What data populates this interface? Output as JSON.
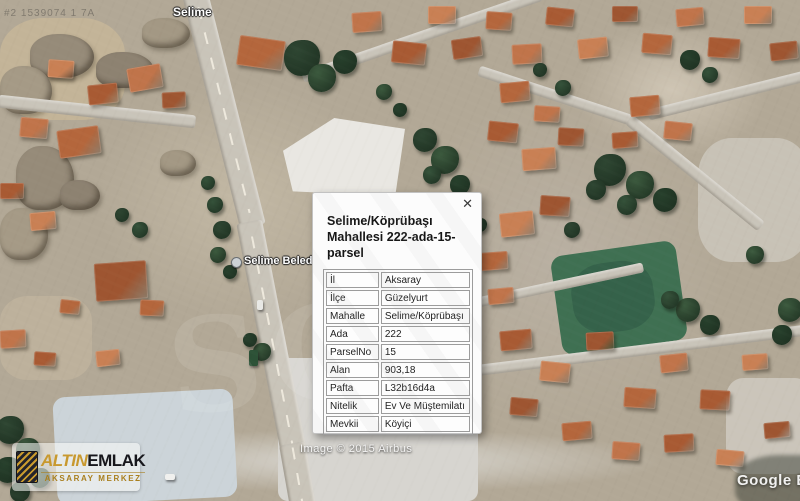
{
  "popup": {
    "title": "Selime/Köprübaşı Mahallesi 222-ada-15-parsel",
    "rows": [
      {
        "label": "İl",
        "value": "Aksaray"
      },
      {
        "label": "İlçe",
        "value": "Güzelyurt"
      },
      {
        "label": "Mahalle",
        "value": "Selime/Köprübaşı"
      },
      {
        "label": "Ada",
        "value": "222"
      },
      {
        "label": "ParselNo",
        "value": "15"
      },
      {
        "label": "Alan",
        "value": "903,18"
      },
      {
        "label": "Pafta",
        "value": "L32b16d4a"
      },
      {
        "label": "Nitelik",
        "value": "Ev Ve Müştemilatı"
      },
      {
        "label": "Mevkii",
        "value": "Köyiçi"
      }
    ]
  },
  "icons": {
    "close": "✕"
  },
  "map": {
    "place_labels": {
      "town": "Selime",
      "municipality": "Selime Beledi"
    },
    "attribution": {
      "imagery": "Image © 2015 Airbus",
      "brand": "Google Eart"
    },
    "faint_id": "#2 1539074 1 7A",
    "ghost_watermark": "SC"
  },
  "logo": {
    "brand_gold": "ALTIN",
    "brand_dark": "EMLAK",
    "subtitle": "AKSARAY MERKEZ"
  },
  "colors": {
    "roof_variants": [
      "#b4663c",
      "#c0744a",
      "#a85a33",
      "#c98054",
      "#9e5531"
    ],
    "tree_variants": [
      "#2e4632",
      "#3c5a3e",
      "#27402c",
      "#35523a"
    ],
    "field": "#3f7052",
    "field_dark": "#35624a",
    "road": "#c9c4b9",
    "rock_variants": [
      "#968b79",
      "#a59a86",
      "#8d8271",
      "#a39884"
    ],
    "logo_gold": "#c8992f",
    "logo_dark": "#17171c"
  }
}
